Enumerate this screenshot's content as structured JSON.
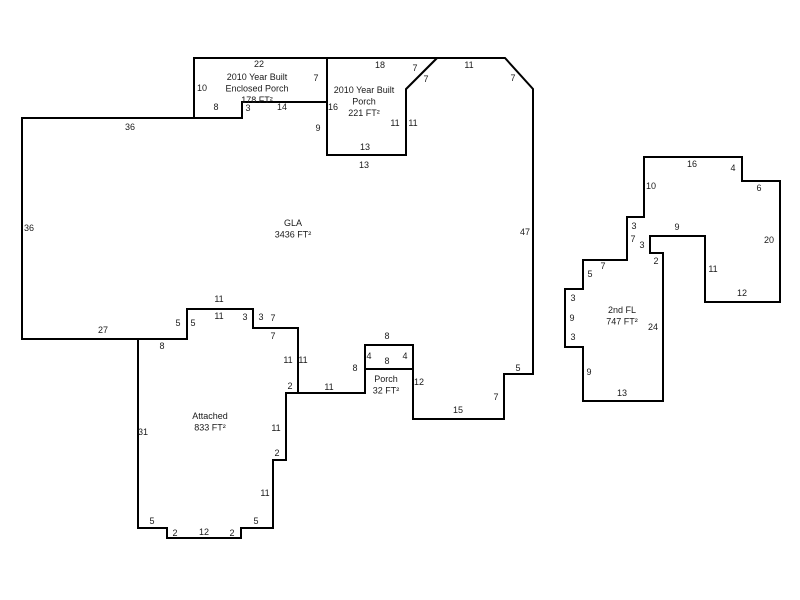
{
  "canvas": {
    "width": 800,
    "height": 600,
    "background": "#ffffff",
    "wall_color": "#000000",
    "text_color": "#1a1a1a"
  },
  "shapes": [
    {
      "id": "gla",
      "label_lines": [
        "GLA",
        "3436 FT²"
      ],
      "label_x": 293,
      "label_y": 223,
      "points": [
        [
          22,
          118
        ],
        [
          242,
          118
        ],
        [
          242,
          102
        ],
        [
          327,
          102
        ],
        [
          327,
          155
        ],
        [
          406,
          155
        ],
        [
          406,
          89
        ],
        [
          437,
          58
        ],
        [
          505,
          58
        ],
        [
          533,
          89
        ],
        [
          533,
          374
        ],
        [
          504,
          374
        ],
        [
          504,
          419
        ],
        [
          413,
          419
        ],
        [
          413,
          345
        ],
        [
          365,
          345
        ],
        [
          365,
          393
        ],
        [
          298,
          393
        ],
        [
          298,
          328
        ],
        [
          253,
          328
        ],
        [
          253,
          309
        ],
        [
          187,
          309
        ],
        [
          187,
          339
        ],
        [
          22,
          339
        ]
      ]
    },
    {
      "id": "enclosed-porch",
      "label_lines": [
        "2010 Year Built",
        "Enclosed Porch",
        "178 FT²"
      ],
      "label_x": 257,
      "label_y": 77,
      "points": [
        [
          194,
          58
        ],
        [
          327,
          58
        ],
        [
          327,
          102
        ],
        [
          242,
          102
        ],
        [
          242,
          118
        ],
        [
          194,
          118
        ]
      ]
    },
    {
      "id": "year-built-porch",
      "label_lines": [
        "2010 Year Built",
        "Porch",
        "221 FT²"
      ],
      "label_x": 364,
      "label_y": 90,
      "points": [
        [
          327,
          58
        ],
        [
          437,
          58
        ],
        [
          406,
          89
        ],
        [
          406,
          155
        ],
        [
          327,
          155
        ]
      ]
    },
    {
      "id": "porch-32",
      "label_lines": [
        "Porch",
        "32 FT²"
      ],
      "label_x": 386,
      "label_y": 379,
      "points": [
        [
          365,
          345
        ],
        [
          413,
          345
        ],
        [
          413,
          369
        ],
        [
          365,
          369
        ]
      ]
    },
    {
      "id": "attached-garage",
      "label_lines": [
        "Attached",
        "833 FT²"
      ],
      "label_x": 210,
      "label_y": 416,
      "points": [
        [
          138,
          339
        ],
        [
          187,
          339
        ],
        [
          187,
          309
        ],
        [
          253,
          309
        ],
        [
          253,
          328
        ],
        [
          298,
          328
        ],
        [
          298,
          393
        ],
        [
          286,
          393
        ],
        [
          286,
          460
        ],
        [
          273,
          460
        ],
        [
          273,
          528
        ],
        [
          241,
          528
        ],
        [
          241,
          538
        ],
        [
          167,
          538
        ],
        [
          167,
          528
        ],
        [
          138,
          528
        ]
      ]
    },
    {
      "id": "second-floor",
      "label_lines": [
        "2nd FL",
        "747 FT²"
      ],
      "label_x": 622,
      "label_y": 310,
      "points": [
        [
          644,
          157
        ],
        [
          742,
          157
        ],
        [
          742,
          181
        ],
        [
          780,
          181
        ],
        [
          780,
          302
        ],
        [
          705,
          302
        ],
        [
          705,
          236
        ],
        [
          650,
          236
        ],
        [
          650,
          253
        ],
        [
          663,
          253
        ],
        [
          663,
          401
        ],
        [
          583,
          401
        ],
        [
          583,
          347
        ],
        [
          565,
          347
        ],
        [
          565,
          289
        ],
        [
          583,
          289
        ],
        [
          583,
          260
        ],
        [
          627,
          260
        ],
        [
          627,
          217
        ],
        [
          644,
          217
        ]
      ]
    }
  ],
  "dimensions": [
    {
      "t": "22",
      "x": 259,
      "y": 64
    },
    {
      "t": "10",
      "x": 202,
      "y": 88
    },
    {
      "t": "7",
      "x": 316,
      "y": 78
    },
    {
      "t": "8",
      "x": 216,
      "y": 107
    },
    {
      "t": "3",
      "x": 248,
      "y": 108
    },
    {
      "t": "14",
      "x": 282,
      "y": 107
    },
    {
      "t": "16",
      "x": 333,
      "y": 107
    },
    {
      "t": "9",
      "x": 318,
      "y": 128
    },
    {
      "t": "18",
      "x": 380,
      "y": 65
    },
    {
      "t": "7",
      "x": 415,
      "y": 68
    },
    {
      "t": "7",
      "x": 426,
      "y": 79
    },
    {
      "t": "11",
      "x": 469,
      "y": 65
    },
    {
      "t": "7",
      "x": 513,
      "y": 78
    },
    {
      "t": "11",
      "x": 395,
      "y": 123
    },
    {
      "t": "11",
      "x": 413,
      "y": 123
    },
    {
      "t": "13",
      "x": 365,
      "y": 147
    },
    {
      "t": "13",
      "x": 364,
      "y": 165
    },
    {
      "t": "36",
      "x": 130,
      "y": 127
    },
    {
      "t": "36",
      "x": 29,
      "y": 228
    },
    {
      "t": "47",
      "x": 525,
      "y": 232
    },
    {
      "t": "27",
      "x": 103,
      "y": 330
    },
    {
      "t": "5",
      "x": 518,
      "y": 368
    },
    {
      "t": "7",
      "x": 496,
      "y": 397
    },
    {
      "t": "15",
      "x": 458,
      "y": 410
    },
    {
      "t": "12",
      "x": 419,
      "y": 382
    },
    {
      "t": "8",
      "x": 162,
      "y": 346
    },
    {
      "t": "5",
      "x": 178,
      "y": 323
    },
    {
      "t": "5",
      "x": 193,
      "y": 323
    },
    {
      "t": "11",
      "x": 219,
      "y": 299
    },
    {
      "t": "11",
      "x": 219,
      "y": 316
    },
    {
      "t": "3",
      "x": 245,
      "y": 317
    },
    {
      "t": "3",
      "x": 261,
      "y": 317
    },
    {
      "t": "7",
      "x": 273,
      "y": 318
    },
    {
      "t": "7",
      "x": 273,
      "y": 336
    },
    {
      "t": "11",
      "x": 288,
      "y": 360
    },
    {
      "t": "11",
      "x": 303,
      "y": 360
    },
    {
      "t": "2",
      "x": 290,
      "y": 386
    },
    {
      "t": "11",
      "x": 329,
      "y": 387
    },
    {
      "t": "8",
      "x": 355,
      "y": 368
    },
    {
      "t": "8",
      "x": 387,
      "y": 336
    },
    {
      "t": "4",
      "x": 369,
      "y": 356
    },
    {
      "t": "8",
      "x": 387,
      "y": 361
    },
    {
      "t": "4",
      "x": 405,
      "y": 356
    },
    {
      "t": "31",
      "x": 143,
      "y": 432
    },
    {
      "t": "11",
      "x": 276,
      "y": 428
    },
    {
      "t": "2",
      "x": 277,
      "y": 453
    },
    {
      "t": "11",
      "x": 265,
      "y": 493
    },
    {
      "t": "5",
      "x": 152,
      "y": 521
    },
    {
      "t": "2",
      "x": 175,
      "y": 533
    },
    {
      "t": "12",
      "x": 204,
      "y": 532
    },
    {
      "t": "2",
      "x": 232,
      "y": 533
    },
    {
      "t": "5",
      "x": 256,
      "y": 521
    },
    {
      "t": "16",
      "x": 692,
      "y": 164
    },
    {
      "t": "4",
      "x": 733,
      "y": 168
    },
    {
      "t": "6",
      "x": 759,
      "y": 188
    },
    {
      "t": "10",
      "x": 651,
      "y": 186
    },
    {
      "t": "20",
      "x": 769,
      "y": 240
    },
    {
      "t": "3",
      "x": 634,
      "y": 226
    },
    {
      "t": "7",
      "x": 633,
      "y": 239
    },
    {
      "t": "3",
      "x": 642,
      "y": 245
    },
    {
      "t": "9",
      "x": 677,
      "y": 227
    },
    {
      "t": "2",
      "x": 656,
      "y": 261
    },
    {
      "t": "11",
      "x": 713,
      "y": 269
    },
    {
      "t": "12",
      "x": 742,
      "y": 293
    },
    {
      "t": "24",
      "x": 653,
      "y": 327
    },
    {
      "t": "7",
      "x": 603,
      "y": 266
    },
    {
      "t": "5",
      "x": 590,
      "y": 274
    },
    {
      "t": "3",
      "x": 573,
      "y": 298
    },
    {
      "t": "9",
      "x": 572,
      "y": 318
    },
    {
      "t": "3",
      "x": 573,
      "y": 337
    },
    {
      "t": "9",
      "x": 589,
      "y": 372
    },
    {
      "t": "13",
      "x": 622,
      "y": 393
    }
  ]
}
